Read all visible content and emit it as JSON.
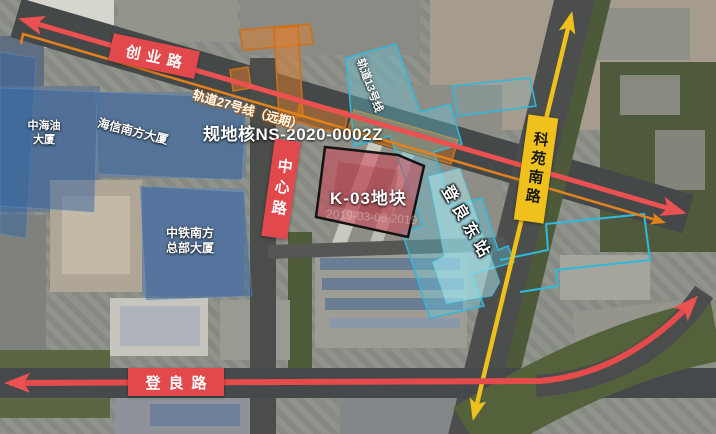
{
  "map": {
    "roads": {
      "chuangye": {
        "label": "创业路"
      },
      "zhongxin": {
        "label": "中心路"
      },
      "dengliang": {
        "label": "登良路"
      },
      "keyuan": {
        "label": "科苑南路"
      }
    },
    "rail_lines": {
      "line27": {
        "label": "轨道27号线（远期）",
        "line_color": "#ea5150",
        "corridor_color": "#e2821e"
      },
      "line13": {
        "label": "轨道13号线",
        "line_color": "#2fb9dc"
      }
    },
    "plot": {
      "label": "K-03地块",
      "code": "规地核NS-2020-0002Z",
      "fill": "#c94b5a",
      "border": "#141414"
    },
    "station": {
      "label": "登良东站"
    },
    "buildings": {
      "cnooc": {
        "line1": "中海油",
        "line2": "大厦"
      },
      "hisense": {
        "label": "海信南方大厦"
      },
      "crcc": {
        "line1": "中铁南方",
        "line2": "总部大厦"
      }
    },
    "watermark": "2019-03-08 2019",
    "banner_colors": {
      "road_red": "#e2494d",
      "road_yellow": "#f0c01c"
    }
  }
}
